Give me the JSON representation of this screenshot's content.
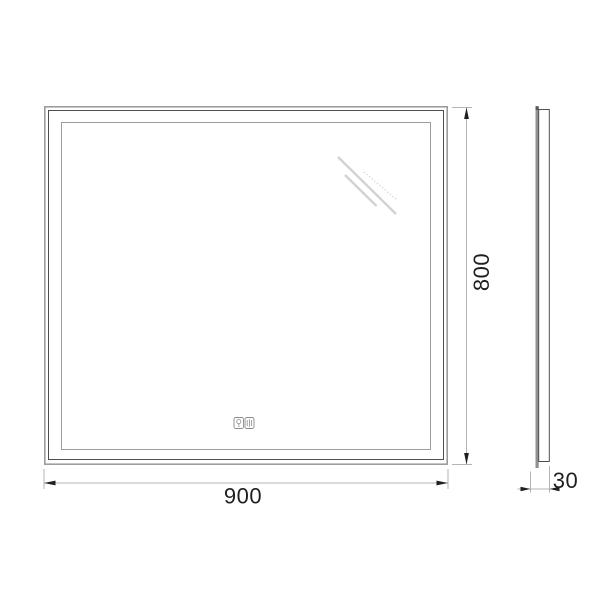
{
  "drawing": {
    "front_view": {
      "width_label": "900",
      "height_label": "800"
    },
    "side_view": {
      "depth_label": "30"
    },
    "touch_controls": {
      "light_button": "bulb-icon",
      "defog_button": "defog-icon"
    },
    "colors": {
      "background": "#ffffff",
      "frame_outer_line": "#9c9c9c",
      "frame_dark_line": "#4f4f4f",
      "led_border_line": "#9c9c9c",
      "reflection_line": "#d2d2d2",
      "dimension_line": "#b5b5b5",
      "arrowhead": "#1f1f1f",
      "dimension_text": "#1f1f1f",
      "side_glass": "#919191"
    }
  }
}
